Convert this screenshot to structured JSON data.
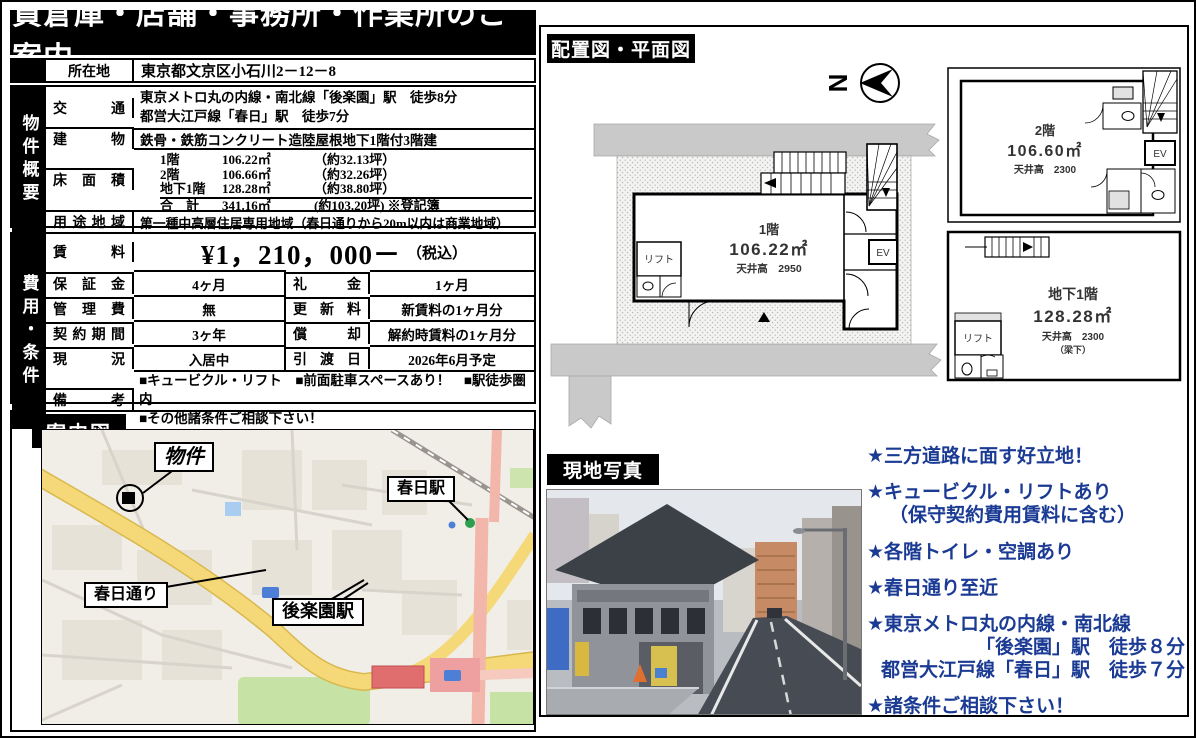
{
  "title": "貸倉庫・店舗・事務所・作業所のご案内",
  "section_labels": {
    "plan": "配置図・平面図",
    "map": "案内図",
    "photo": "現地写真"
  },
  "overview": {
    "side": "物件概要",
    "location_label": "所在地",
    "location": "東京都文京区小石川2－12－8",
    "access_label": "交通",
    "access_line1": "東京メトロ丸の内線・南北線「後楽園」駅　徒歩8分",
    "access_line2": "都営大江戸線「春日」駅　徒歩7分",
    "building_label": "建物",
    "building": "鉄骨・鉄筋コンクリート造陸屋根地下1階付3階建",
    "floor_area_label": "床面積",
    "floor_area": [
      {
        "floor": "1階",
        "area": "106.22㎡",
        "tsubo": "（約32.13坪）"
      },
      {
        "floor": "2階",
        "area": "106.66㎡",
        "tsubo": "（約32.26坪）"
      },
      {
        "floor": "地下1階",
        "area": "128.28㎡",
        "tsubo": "（約38.80坪）"
      },
      {
        "floor": "合　計",
        "area": "341.16㎡",
        "tsubo": "(約103.20坪) ※登記簿"
      }
    ],
    "zoning_label": "用途地域",
    "zoning": "第一種中高層住居専用地域（春日通りから20m以内は商業地域）"
  },
  "cost": {
    "side": "費用・条件",
    "rent_label": "賃料",
    "rent": "¥1，210，000－",
    "rent_suffix": "（税込）",
    "rows": [
      {
        "label1": "保証金",
        "value1": "4ヶ月",
        "label2": "礼金",
        "value2": "1ヶ月"
      },
      {
        "label1": "管理費",
        "value1": "無",
        "label2": "更新料",
        "value2": "新賃料の1ヶ月分"
      },
      {
        "label1": "契約期間",
        "value1": "3ヶ年",
        "label2": "償却",
        "value2": "解約時賃料の1ヶ月分"
      },
      {
        "label1": "現況",
        "value1": "入居中",
        "label2": "引渡日",
        "value2": "2026年6月予定"
      }
    ],
    "notes_label": "備考",
    "notes_line1": "■キュービクル・リフト　■前面駐車スペースあり！　■駅徒歩圏内",
    "notes_line2": "■その他諸条件ご相談下さい！"
  },
  "plans": {
    "compass_letter": "N",
    "f1": {
      "name": "1階",
      "area": "106.22㎡",
      "ceiling": "天井高　2950",
      "lift": "リフト",
      "ev": "EV"
    },
    "f2": {
      "name": "2階",
      "area": "106.60㎡",
      "ceiling": "天井高　2300",
      "ev": "EV"
    },
    "b1": {
      "name": "地下1階",
      "area": "128.28㎡",
      "ceiling": "天井高　2300",
      "ceiling_note": "（梁下）",
      "lift": "リフト"
    }
  },
  "map": {
    "property": "物件",
    "kasuga_station": "春日駅",
    "kasuga_street": "春日通り",
    "korakuen_station": "後楽園駅"
  },
  "highlights": {
    "items": [
      {
        "line1": "★三方道路に面す好立地！"
      },
      {
        "line1": "★キュービクル・リフトあり",
        "line2": "（保守契約費用賃料に含む）"
      },
      {
        "line1": "★各階トイレ・空調あり"
      },
      {
        "line1": "★春日通り至近"
      },
      {
        "line1": "★東京メトロ丸の内線・南北線",
        "line2": "「後楽園」駅　徒歩８分",
        "line3": "都営大江戸線「春日」駅　徒歩７分"
      },
      {
        "line1": "★諸条件ご相談下さい！"
      }
    ]
  },
  "colors": {
    "highlight_blue": "#1a3a94",
    "road_yellow": "#f5d878",
    "road_pink": "#f2b6ab",
    "park_green": "#c6e2a4",
    "station_red": "#e06e6e"
  }
}
